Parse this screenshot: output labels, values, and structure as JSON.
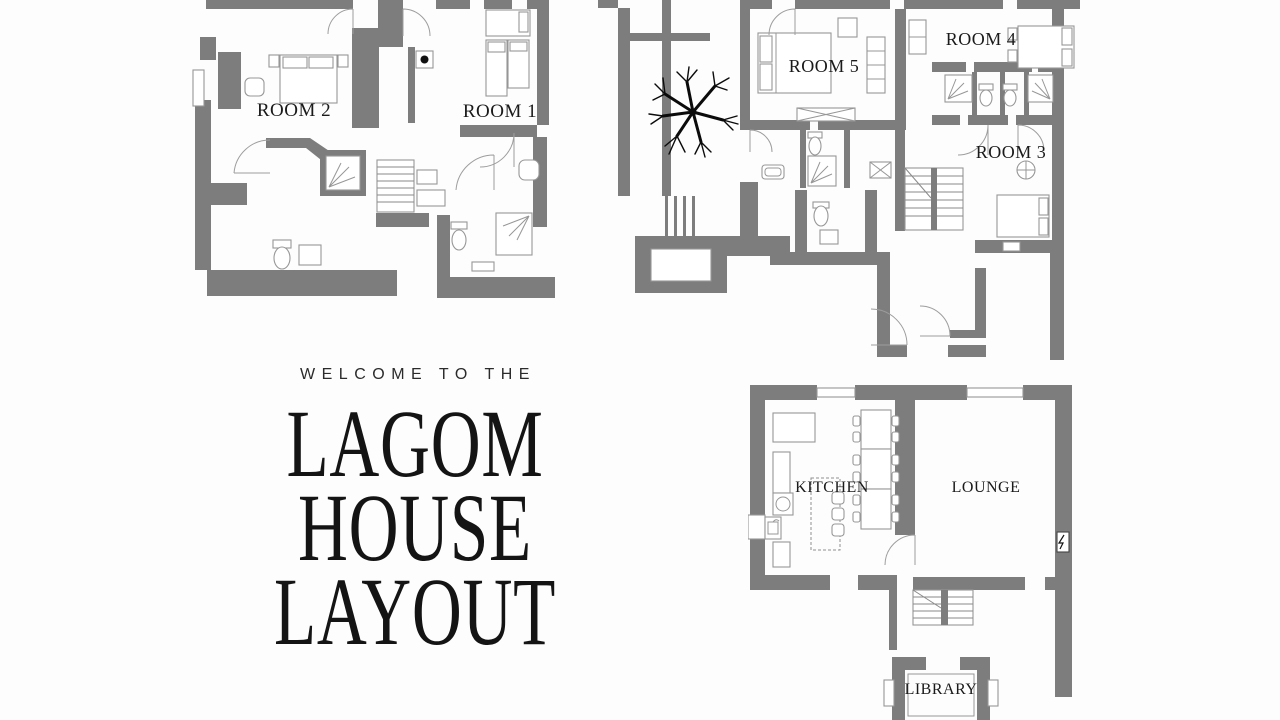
{
  "page": {
    "background": "#fdfdfd"
  },
  "palette": {
    "wall_gray": "#7d7d7d",
    "line_gray": "#979797",
    "ink": "#1a1a1a"
  },
  "hero": {
    "eyebrow": "WELCOME TO THE",
    "title_lines": [
      "LAGOM",
      "HOUSE",
      "LAYOUT"
    ]
  },
  "plans": {
    "upper_left": {
      "rooms": [
        {
          "label": "ROOM 2"
        },
        {
          "label": "ROOM 1"
        }
      ]
    },
    "upper_right": {
      "rooms": [
        {
          "label": "ROOM 5"
        },
        {
          "label": "ROOM 4"
        },
        {
          "label": "ROOM 3"
        }
      ]
    },
    "ground": {
      "rooms": [
        {
          "label": "KITCHEN"
        },
        {
          "label": "LOUNGE"
        },
        {
          "label": "LIBRARY"
        }
      ]
    }
  }
}
